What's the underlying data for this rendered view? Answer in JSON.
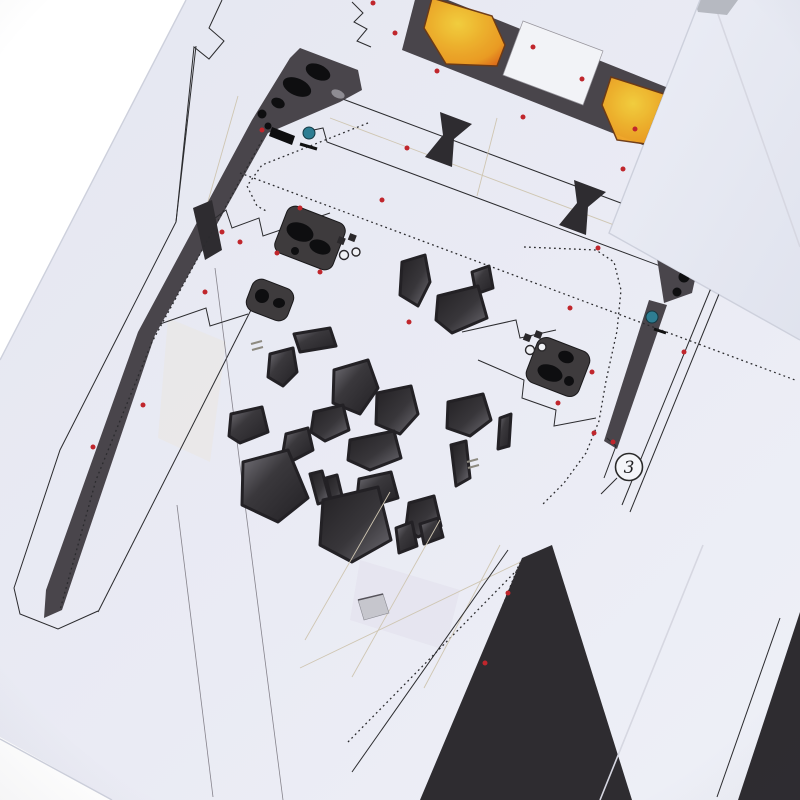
{
  "scene": {
    "type": "photograph",
    "subject": "papercraft model template sheets close-up",
    "description": "Overlapping white printed paper sheets with cut outlines, dotted fold lines, red registration dots, dark charcoal parts, cockpit window panes and orange engine glow panels"
  },
  "marker": {
    "label": "3"
  },
  "colors": {
    "background": "#ffffff",
    "paper": "#e9eaf3",
    "paper_under": "#e6e8f1",
    "print_dark": "#49454b",
    "pane_dark": "#2e2c30",
    "pane_highlight": "#77757c",
    "glow_core": "#f7d23e",
    "glow_mid": "#ef9d22",
    "glow_edge": "#e2711a",
    "teal_rivet": "#2e7d92",
    "cut_dot_red": "#c0262c",
    "fold_line_beige": "#cfc6b2",
    "outline": "#2b2b2e"
  },
  "icons": [
    "part-number-marker",
    "glow-panel",
    "window-pane",
    "registration-dot",
    "teal-rivet"
  ]
}
